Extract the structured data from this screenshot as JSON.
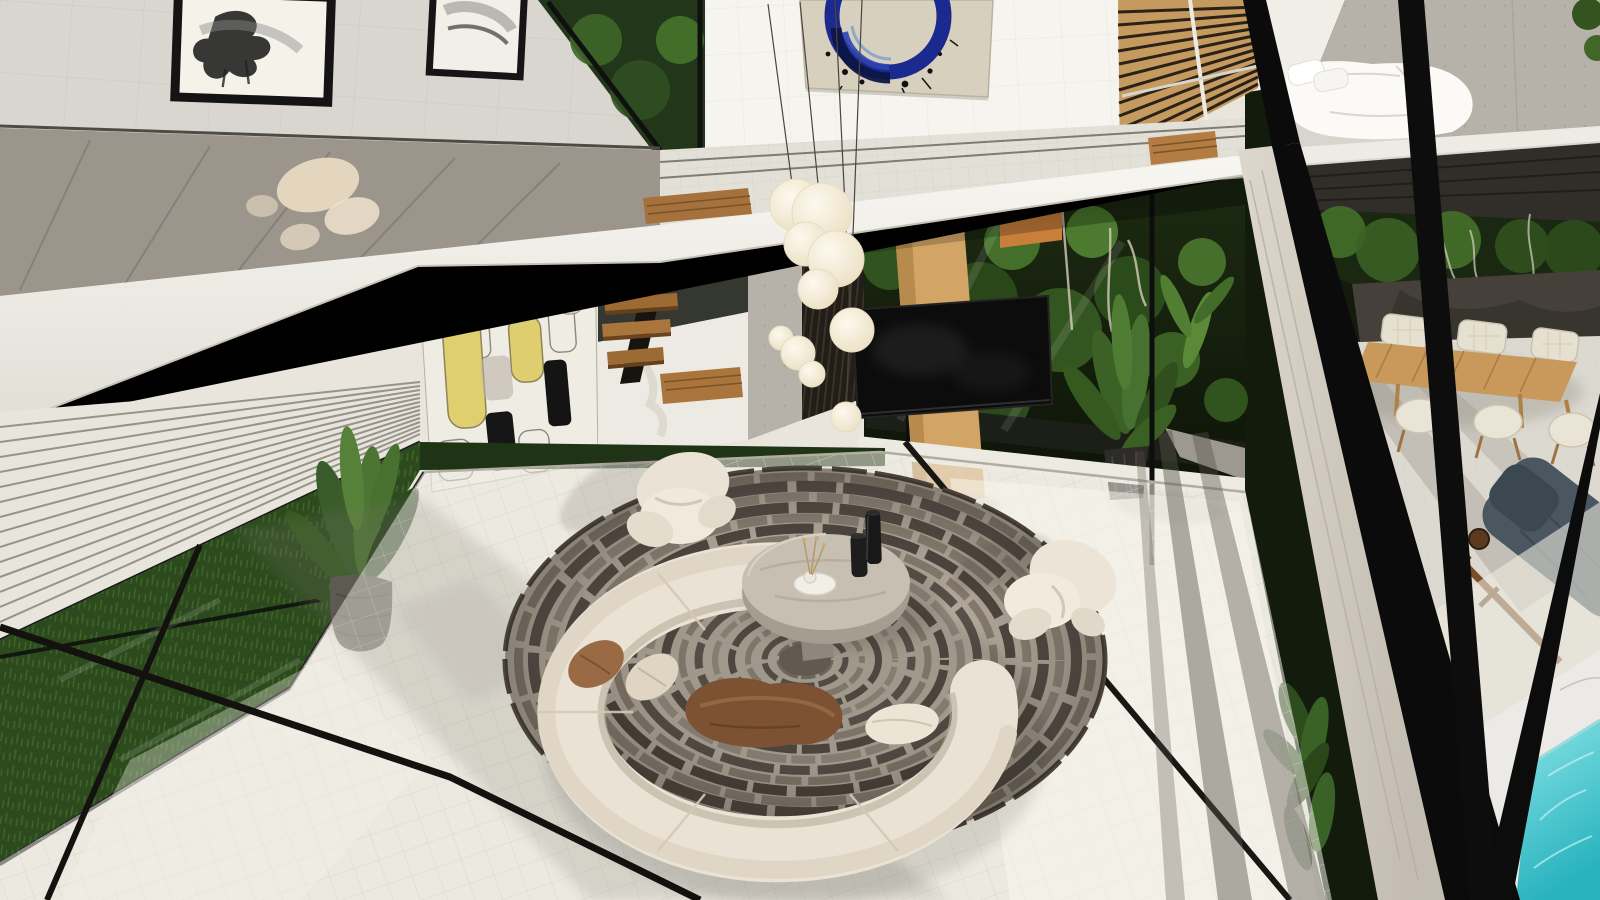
{
  "meta": {
    "title": "Modern double-height villa living room — aerial 3D architectural render",
    "view": "top-down aerial view from mezzanine corner",
    "style": "contemporary minimalist"
  },
  "palette": {
    "floor": "#e9e5dc",
    "floor_bright": "#faf7ee",
    "floor_shadow": "#7d786e",
    "wall_white": "#f6f4ef",
    "wall_tile_grey": "#d9d6d0",
    "fascia": "#f4f2ec",
    "balustrade_glass": "#9b958c",
    "balustrade_reflection": "#ecdcc3",
    "louver": "#e8e5dd",
    "grass": "#2c4a1e",
    "foliage_dark": "#131b0d",
    "foliage_light": "#4c7a2e",
    "wood_slat_screen": "#c59a5e",
    "wood_stair": "#9c6a33",
    "wood_column": "#d2a566",
    "concrete": "#b6b2a9",
    "frame_black": "#0b0b0b",
    "beam_light": "#d5cfc4",
    "rug_base": "#b3aa9c",
    "rug_dark": "#554e45",
    "rug_mid": "#8b8174",
    "sofa_cream": "#eae3d5",
    "cushion_brown": "#9a6a45",
    "blanket_brown": "#7d5233",
    "pillow_cream": "#e0d5c2",
    "table_stone_top": "#c6bfb2",
    "table_stone_side": "#a59d90",
    "vase_black": "#181818",
    "pendant_cream": "#f4ecd9",
    "art_canvas": "#d8d0bf",
    "art_blue": "#1b2a8e",
    "art_navy": "#0d1546",
    "accent_yellow": "#e0cf6e",
    "panel_bg": "#efece4",
    "tv_black": "#0c0c0c",
    "bed_white": "#fbfaf7",
    "mattress_grey": "#d8d5ce",
    "deck_dark": "#312e29",
    "terrace_wall": "#45413a",
    "dining_wood": "#c9995c",
    "chair_cream": "#e6e0d1",
    "lounge_cushion": "#4a5761",
    "lounge_frame": "#7a4e28",
    "marble": "#eceae6",
    "pool_water_light": "#8ae4e6",
    "pool_water_deep": "#29b3bf"
  },
  "rug": {
    "cx": 805,
    "cy": 660,
    "rx": 300,
    "ry": 192,
    "base": "#b3aa9c",
    "center": "#6e6559",
    "rings": [
      {
        "f": 1.0,
        "c": "#4a433b",
        "w": 5,
        "d": "60 10 35 8"
      },
      {
        "f": 0.955,
        "c": "#837a6d",
        "w": 9,
        "d": "48 7 30 6"
      },
      {
        "f": 0.905,
        "c": "#59514a",
        "w": 11,
        "d": "70 9 40 7"
      },
      {
        "f": 0.85,
        "c": "#90867a",
        "w": 9,
        "d": "44 8 26 6"
      },
      {
        "f": 0.795,
        "c": "#544d44",
        "w": 11,
        "d": "64 8 36 7"
      },
      {
        "f": 0.74,
        "c": "#8a8073",
        "w": 9,
        "d": "50 7 30 5"
      },
      {
        "f": 0.685,
        "c": "#4f4840",
        "w": 10,
        "d": "58 9 34 6"
      },
      {
        "f": 0.63,
        "c": "#867c6f",
        "w": 8,
        "d": "42 7 26 5"
      },
      {
        "f": 0.575,
        "c": "#5a524a",
        "w": 9,
        "d": "54 8 30 6"
      },
      {
        "f": 0.52,
        "c": "#938a7d",
        "w": 8,
        "d": "40 6 24 5"
      },
      {
        "f": 0.465,
        "c": "#544d45",
        "w": 9,
        "d": "50 7 28 5"
      },
      {
        "f": 0.41,
        "c": "#8c8275",
        "w": 7,
        "d": "38 6 22 4"
      },
      {
        "f": 0.355,
        "c": "#5f574e",
        "w": 8,
        "d": "46 7 26 5"
      },
      {
        "f": 0.3,
        "c": "#968c7f",
        "w": 6,
        "d": "34 5 20 4"
      },
      {
        "f": 0.245,
        "c": "#585047",
        "w": 7,
        "d": "40 6 24 4"
      },
      {
        "f": 0.19,
        "c": "#8f8578",
        "w": 6,
        "d": "30 5 18 4"
      },
      {
        "f": 0.135,
        "c": "#5c544b",
        "w": 6,
        "d": "34 5 20 4"
      },
      {
        "f": 0.085,
        "c": "#7c7367",
        "w": 6,
        "d": "26 4 14 3"
      }
    ]
  },
  "scene": {
    "objects": [
      {
        "name": "tiled-floor",
        "note": "large cream ceramic tile floor with sun and mullion shadows"
      },
      {
        "name": "circular-rug",
        "note": "round rug of concentric taupe-and-grey broken rings"
      },
      {
        "name": "curved-sofa",
        "note": "crescent cream boucle sofa opening toward coffee table"
      },
      {
        "name": "armchair-left",
        "note": "organic cream lounge chair on rug edge"
      },
      {
        "name": "armchair-right",
        "note": "organic cream lounge chair on rug edge"
      },
      {
        "name": "coffee-table",
        "note": "round grey stone drum table"
      },
      {
        "name": "black-vases",
        "note": "two black cylinder vases on table"
      },
      {
        "name": "decor-tray",
        "note": "white tray with mini vase and dried sprigs"
      },
      {
        "name": "throw-pillows",
        "note": "rust and cream pillows with brown draped throw"
      },
      {
        "name": "pendant-lights",
        "note": "cascading cream pebble-shaped pendant cluster"
      },
      {
        "name": "mezzanine-walkway",
        "note": "white bridge with glass balustrade"
      },
      {
        "name": "framed-artworks",
        "note": "two black-framed abstract ink paintings, upper-left wall"
      },
      {
        "name": "blue-circle-artwork",
        "note": "large canvas with deep blue brush ring"
      },
      {
        "name": "patterned-wall-panel",
        "note": "graphic panel of outlined rounded rectangles with yellow and black fills"
      },
      {
        "name": "floating-staircase",
        "note": "walnut treads on black steel stringer"
      },
      {
        "name": "wood-slat-screen",
        "note": "warm timber slat screen, upper right wall"
      },
      {
        "name": "tv-on-column",
        "note": "flat TV mounted on tan timber column"
      },
      {
        "name": "louvered-blinds",
        "note": "white louvers, lower-left glazing"
      },
      {
        "name": "indoor-grass-strip",
        "note": "green grass bed behind glass, lower left"
      },
      {
        "name": "potted-plants",
        "note": "stone-pot palm left, dark-pot palm right, ferns by glass corner"
      },
      {
        "name": "bedroom-mezzanine",
        "note": "white bed against board-formed concrete wall, upper right"
      },
      {
        "name": "outdoor-dining-set",
        "note": "timber table with six cream upholstered chairs on terrace"
      },
      {
        "name": "sun-lounger",
        "note": "timber lounger with slate blue cushion"
      },
      {
        "name": "swimming-pool",
        "note": "turquoise pool with white marble coping, bottom right"
      },
      {
        "name": "black-steel-frame",
        "note": "black glazing mullions and diagonal corner braces"
      }
    ]
  }
}
